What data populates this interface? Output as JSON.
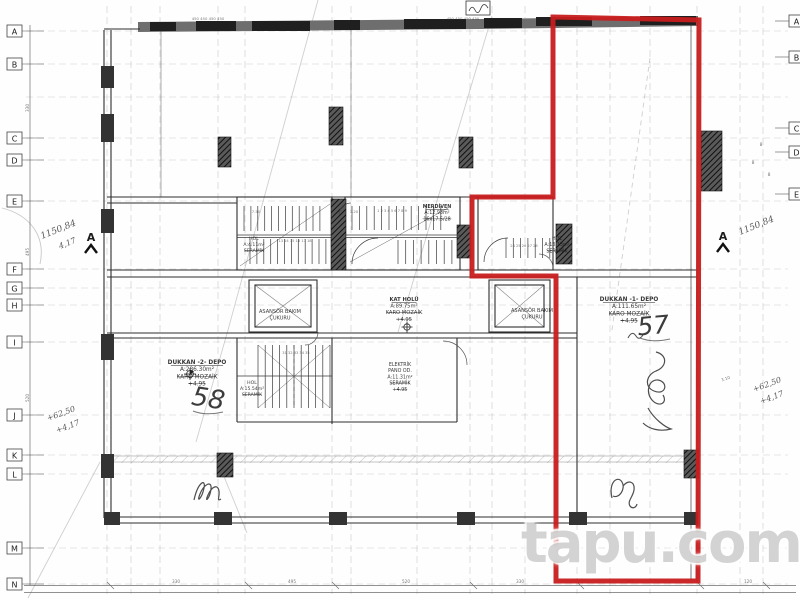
{
  "watermark": {
    "text": "tapu.com"
  },
  "colors": {
    "red_outline": "#c81e1e",
    "ink": "#2b2b2b"
  },
  "section_markers": {
    "left": "A",
    "right": "A"
  },
  "grid_letters": {
    "left": [
      {
        "t": "A",
        "y": 31
      },
      {
        "t": "B",
        "y": 64
      },
      {
        "t": "C",
        "y": 138
      },
      {
        "t": "D",
        "y": 160
      },
      {
        "t": "E",
        "y": 201
      },
      {
        "t": "F",
        "y": 269
      },
      {
        "t": "G",
        "y": 288
      },
      {
        "t": "H",
        "y": 305
      },
      {
        "t": "I",
        "y": 342
      },
      {
        "t": "J",
        "y": 415
      },
      {
        "t": "K",
        "y": 455
      },
      {
        "t": "L",
        "y": 474
      },
      {
        "t": "M",
        "y": 548
      },
      {
        "t": "N",
        "y": 584
      }
    ],
    "right": [
      {
        "t": "A",
        "y": 21
      },
      {
        "t": "B",
        "y": 57
      },
      {
        "t": "C",
        "y": 128
      },
      {
        "t": "D",
        "y": 152
      },
      {
        "t": "E",
        "y": 194
      }
    ]
  },
  "room_labels": [
    {
      "name": "merdiven",
      "x": 437,
      "y": 208,
      "fs": 4.8,
      "lines": [
        {
          "t": "MERDİVEN",
          "u": 1
        },
        {
          "t": "A:12.93m²"
        },
        {
          "t": "16x17.5/28",
          "s": 1
        }
      ]
    },
    {
      "name": "kat-holu",
      "x": 404,
      "y": 301,
      "fs": 5.2,
      "lines": [
        {
          "t": "KAT HOLÜ",
          "u": 1
        },
        {
          "t": "A:89.75m²"
        },
        {
          "t": "KARO MOZAİK",
          "s": 1
        },
        {
          "t": "+4.95",
          "s": 1
        }
      ]
    },
    {
      "name": "asansor-bakim-sol",
      "x": 280,
      "y": 313,
      "fs": 5,
      "lines": [
        {
          "t": "ASANSÖR BAKIM"
        },
        {
          "t": "ÇUKURU"
        }
      ]
    },
    {
      "name": "asansor-bakim-sag",
      "x": 532,
      "y": 312,
      "fs": 5,
      "lines": [
        {
          "t": "ASANSÖR BAKIM"
        },
        {
          "t": "ÇUKURU"
        }
      ]
    },
    {
      "name": "hol-notch",
      "x": 557,
      "y": 240,
      "fs": 4.8,
      "lines": [
        {
          "t": "HOL"
        },
        {
          "t": "A:13.13m²"
        },
        {
          "t": "SERAMİK",
          "s": 1
        }
      ]
    },
    {
      "name": "hol-core",
      "x": 254,
      "y": 240,
      "fs": 4.6,
      "lines": [
        {
          "t": "HOL"
        },
        {
          "t": "A:4.11m²"
        },
        {
          "t": "SERAMİK",
          "s": 1
        }
      ]
    },
    {
      "name": "hol-lower",
      "x": 252,
      "y": 384,
      "fs": 4.6,
      "lines": [
        {
          "t": "HOL"
        },
        {
          "t": "A:15.54m²"
        },
        {
          "t": "SERAMİK",
          "s": 1
        }
      ]
    },
    {
      "name": "elektrik-pano",
      "x": 400,
      "y": 366,
      "fs": 4.8,
      "lines": [
        {
          "t": "ELEKTRİK"
        },
        {
          "t": "PANO OD."
        },
        {
          "t": "A:11.31m²"
        },
        {
          "t": "SERAMİK",
          "s": 1
        },
        {
          "t": "+4.95",
          "s": 1
        }
      ]
    },
    {
      "name": "dukkan-57",
      "x": 629,
      "y": 301,
      "fs": 5.8,
      "lines": [
        {
          "t": "DÜKKAN -1- DEPO",
          "u": 1
        },
        {
          "t": "A:111.65m²"
        },
        {
          "t": "KARO MOZAİK",
          "s": 1
        },
        {
          "t": "+4.95",
          "s": 1
        }
      ]
    },
    {
      "name": "dukkan-58",
      "x": 197,
      "y": 364,
      "fs": 5.8,
      "lines": [
        {
          "t": "DÜKKAN -2- DEPO",
          "u": 1
        },
        {
          "t": "A:286.30m²"
        },
        {
          "t": "KARO MOZAİK",
          "s": 1
        },
        {
          "t": "+4.95",
          "s": 1
        }
      ]
    }
  ],
  "unit_numbers": [
    {
      "t": "57",
      "x": 654,
      "y": 334,
      "rot": -5,
      "fs": 25
    },
    {
      "t": "58",
      "x": 207,
      "y": 407,
      "rot": 9,
      "fs": 26
    }
  ],
  "handwriting": [
    {
      "t": "1150,84",
      "x": 42,
      "y": 239,
      "rot": -22,
      "fs": 9
    },
    {
      "t": "4,17",
      "x": 60,
      "y": 249,
      "rot": -22,
      "fs": 8
    },
    {
      "t": "1150,84",
      "x": 740,
      "y": 235,
      "rot": -22,
      "fs": 9
    },
    {
      "t": "+62,50",
      "x": 48,
      "y": 421,
      "rot": -20,
      "fs": 8
    },
    {
      "t": "+4,17",
      "x": 57,
      "y": 433,
      "rot": -20,
      "fs": 8
    },
    {
      "t": "+62,50",
      "x": 754,
      "y": 392,
      "rot": -20,
      "fs": 8
    },
    {
      "t": "+4,17",
      "x": 761,
      "y": 404,
      "rot": -20,
      "fs": 8
    }
  ],
  "dim_marks": [
    {
      "t": "450 450 450 450",
      "x": 208,
      "y": 20,
      "fs": 3.8
    },
    {
      "t": "450 450 450 450",
      "x": 463,
      "y": 20,
      "fs": 3.8
    },
    {
      "t": "330",
      "x": 176,
      "y": 583
    },
    {
      "t": "495",
      "x": 292,
      "y": 583
    },
    {
      "t": "520",
      "x": 406,
      "y": 583
    },
    {
      "t": "330",
      "x": 520,
      "y": 583
    },
    {
      "t": "495",
      "x": 630,
      "y": 583
    },
    {
      "t": "120",
      "x": 748,
      "y": 583
    },
    {
      "t": "330",
      "x": 29,
      "y": 108,
      "rot": -90
    },
    {
      "t": "495",
      "x": 29,
      "y": 252,
      "rot": -90
    },
    {
      "t": "520",
      "x": 29,
      "y": 398,
      "rot": -90
    },
    {
      "t": "8",
      "x": 761,
      "y": 146,
      "fs": 4.5
    },
    {
      "t": "8",
      "x": 753,
      "y": 164,
      "fs": 4.5
    },
    {
      "t": "8",
      "x": 769,
      "y": 176,
      "fs": 4.5
    },
    {
      "t": "7.50",
      "x": 256,
      "y": 213,
      "fs": 3.8
    },
    {
      "t": "1.20",
      "x": 354,
      "y": 213,
      "fs": 3.8
    },
    {
      "t": "13 14 15 16 17 18",
      "x": 295,
      "y": 242,
      "fs": 3.6
    },
    {
      "t": "1 2 3 4 5 6 7 8 9",
      "x": 392,
      "y": 212,
      "fs": 3.6
    },
    {
      "t": "24 25 26 27 28",
      "x": 524,
      "y": 247,
      "fs": 3.6
    },
    {
      "t": "31 32 33 34 35",
      "x": 296,
      "y": 354,
      "fs": 3.6
    },
    {
      "t": "3.10",
      "x": 726,
      "y": 380,
      "fs": 4,
      "rot": -18
    }
  ]
}
